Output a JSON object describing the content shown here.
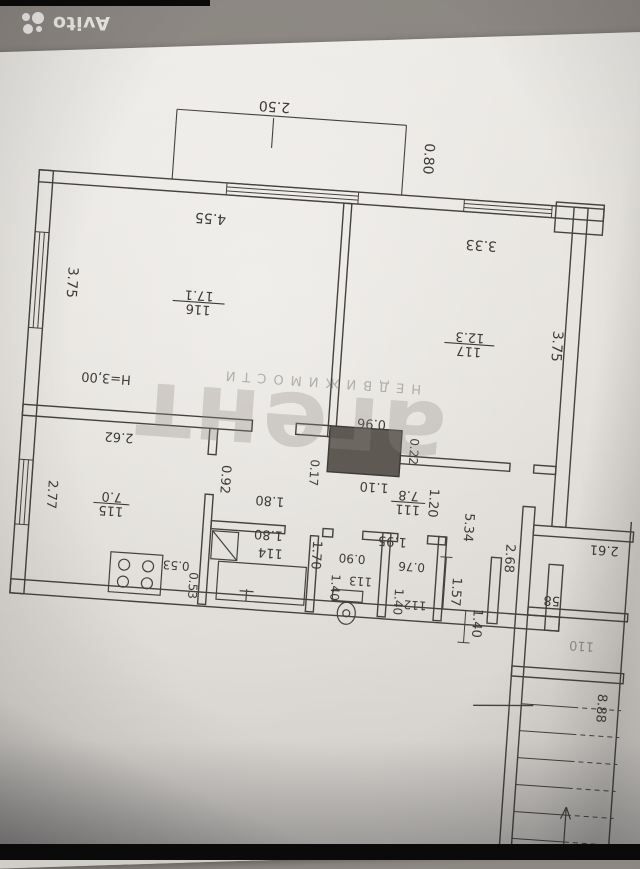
{
  "brand": {
    "name": "Avito"
  },
  "watermark": {
    "small": "НЕДВИЖИМОСТИ",
    "big": "агент"
  },
  "colors": {
    "ink": "#3e3b37",
    "faint": "#8f8a82",
    "wall": "#45423e"
  },
  "plan": {
    "ceiling_height": "H=3,00",
    "labels": [
      {
        "id": "balcony-width",
        "text": "2.50",
        "x": 252,
        "y": 106,
        "rot": 180,
        "s": 14
      },
      {
        "id": "balcony-depth",
        "text": "0.80",
        "x": 405,
        "y": 152,
        "rot": 90,
        "s": 14
      },
      {
        "id": "room116-width",
        "text": "4.55",
        "x": 196,
        "y": 222,
        "rot": 180,
        "s": 14
      },
      {
        "id": "room117-width",
        "text": "3.33",
        "x": 468,
        "y": 230,
        "rot": 180,
        "s": 14
      },
      {
        "id": "left-wall-dim",
        "text": "3.75",
        "x": 58,
        "y": 300,
        "rot": 90,
        "s": 14
      },
      {
        "id": "right-wall-dim",
        "text": "3.75",
        "x": 546,
        "y": 330,
        "rot": 90,
        "s": 14
      },
      {
        "id": "room116-area",
        "text": "17.1",
        "x": 190,
        "y": 300,
        "rot": 180,
        "s": 13
      },
      {
        "id": "room116-number",
        "text": "116",
        "x": 190,
        "y": 314,
        "rot": 180,
        "s": 13
      },
      {
        "id": "room117-area",
        "text": "12.3",
        "x": 463,
        "y": 323,
        "rot": 180,
        "s": 13
      },
      {
        "id": "room117-number",
        "text": "117",
        "x": 463,
        "y": 337,
        "rot": 180,
        "s": 13
      },
      {
        "id": "ceiling-height",
        "text": "H=3,00",
        "x": 103,
        "y": 389,
        "rot": 180,
        "s": 13
      },
      {
        "id": "kitchen-width",
        "text": "2.62",
        "x": 120,
        "y": 447,
        "rot": 180,
        "s": 13
      },
      {
        "id": "kitchen-height",
        "text": "2.77",
        "x": 53,
        "y": 513,
        "rot": 90,
        "s": 13
      },
      {
        "id": "room115-area",
        "text": "7.0",
        "x": 117,
        "y": 507,
        "rot": 180,
        "s": 13
      },
      {
        "id": "room115-number",
        "text": "115",
        "x": 117,
        "y": 521,
        "rot": 180,
        "s": 13
      },
      {
        "id": "kitchen-053-h",
        "text": "0.53",
        "x": 186,
        "y": 571,
        "rot": 180,
        "s": 12
      },
      {
        "id": "kitchen-053-v",
        "text": "0.53",
        "x": 200,
        "y": 594,
        "rot": 90,
        "s": 12
      },
      {
        "id": "door-092",
        "text": "0.92",
        "x": 225,
        "y": 486,
        "rot": 90,
        "s": 13
      },
      {
        "id": "dim-017",
        "text": "0.17",
        "x": 313,
        "y": 473,
        "rot": 90,
        "s": 12
      },
      {
        "id": "bath-180-a",
        "text": "1.80",
        "x": 275,
        "y": 500,
        "rot": 180,
        "s": 13
      },
      {
        "id": "bath-180-b",
        "text": "1.80",
        "x": 276,
        "y": 534,
        "rot": 180,
        "s": 13
      },
      {
        "id": "room114-number",
        "text": "114",
        "x": 279,
        "y": 552,
        "rot": 180,
        "s": 13
      },
      {
        "id": "bath-height",
        "text": "1.70",
        "x": 321,
        "y": 555,
        "rot": 90,
        "s": 13
      },
      {
        "id": "vent-096",
        "text": "0.96",
        "x": 371,
        "y": 416,
        "rot": 180,
        "s": 13
      },
      {
        "id": "vent-022",
        "text": "0.22",
        "x": 411,
        "y": 445,
        "rot": 90,
        "s": 12
      },
      {
        "id": "hall-110",
        "text": "1.10",
        "x": 378,
        "y": 479,
        "rot": 180,
        "s": 13
      },
      {
        "id": "room111-area",
        "text": "7.8",
        "x": 413,
        "y": 485,
        "rot": 180,
        "s": 13
      },
      {
        "id": "room111-number",
        "text": "111",
        "x": 413,
        "y": 499,
        "rot": 180,
        "s": 13
      },
      {
        "id": "hall-120",
        "text": "1.20",
        "x": 434,
        "y": 495,
        "rot": 90,
        "s": 13
      },
      {
        "id": "hall-534",
        "text": "5.34",
        "x": 471,
        "y": 517,
        "rot": 90,
        "s": 13
      },
      {
        "id": "entry-195",
        "text": "1.95",
        "x": 400,
        "y": 532,
        "rot": 180,
        "s": 13
      },
      {
        "id": "wc-090",
        "text": "0.90",
        "x": 361,
        "y": 552,
        "rot": 180,
        "s": 12
      },
      {
        "id": "wc-140",
        "text": "1.40",
        "x": 342,
        "y": 586,
        "rot": 90,
        "s": 12
      },
      {
        "id": "room113-number",
        "text": "113",
        "x": 371,
        "y": 574,
        "rot": 180,
        "s": 12
      },
      {
        "id": "closet-076",
        "text": "0.76",
        "x": 421,
        "y": 556,
        "rot": 180,
        "s": 12
      },
      {
        "id": "closet-140",
        "text": "1.40",
        "x": 406,
        "y": 596,
        "rot": 90,
        "s": 12
      },
      {
        "id": "room112-number",
        "text": "112",
        "x": 427,
        "y": 594,
        "rot": 180,
        "s": 12
      },
      {
        "id": "entry-157",
        "text": "1.57",
        "x": 463,
        "y": 582,
        "rot": 90,
        "s": 13
      },
      {
        "id": "entry-140",
        "text": "1.40",
        "x": 486,
        "y": 612,
        "rot": 90,
        "s": 13
      },
      {
        "id": "landing-268",
        "text": "2.68",
        "x": 514,
        "y": 545,
        "rot": 90,
        "s": 13
      },
      {
        "id": "landing-number",
        "text": "58",
        "x": 563,
        "y": 580,
        "rot": 180,
        "s": 13
      },
      {
        "id": "landing-261",
        "text": "2.61",
        "x": 612,
        "y": 526,
        "rot": 180,
        "s": 13
      },
      {
        "id": "room110-number",
        "text": "110",
        "x": 596,
        "y": 623,
        "rot": 180,
        "s": 13,
        "light": true
      },
      {
        "id": "stair-888",
        "text": "8.88",
        "x": 616,
        "y": 688,
        "rot": 90,
        "s": 13
      }
    ]
  }
}
